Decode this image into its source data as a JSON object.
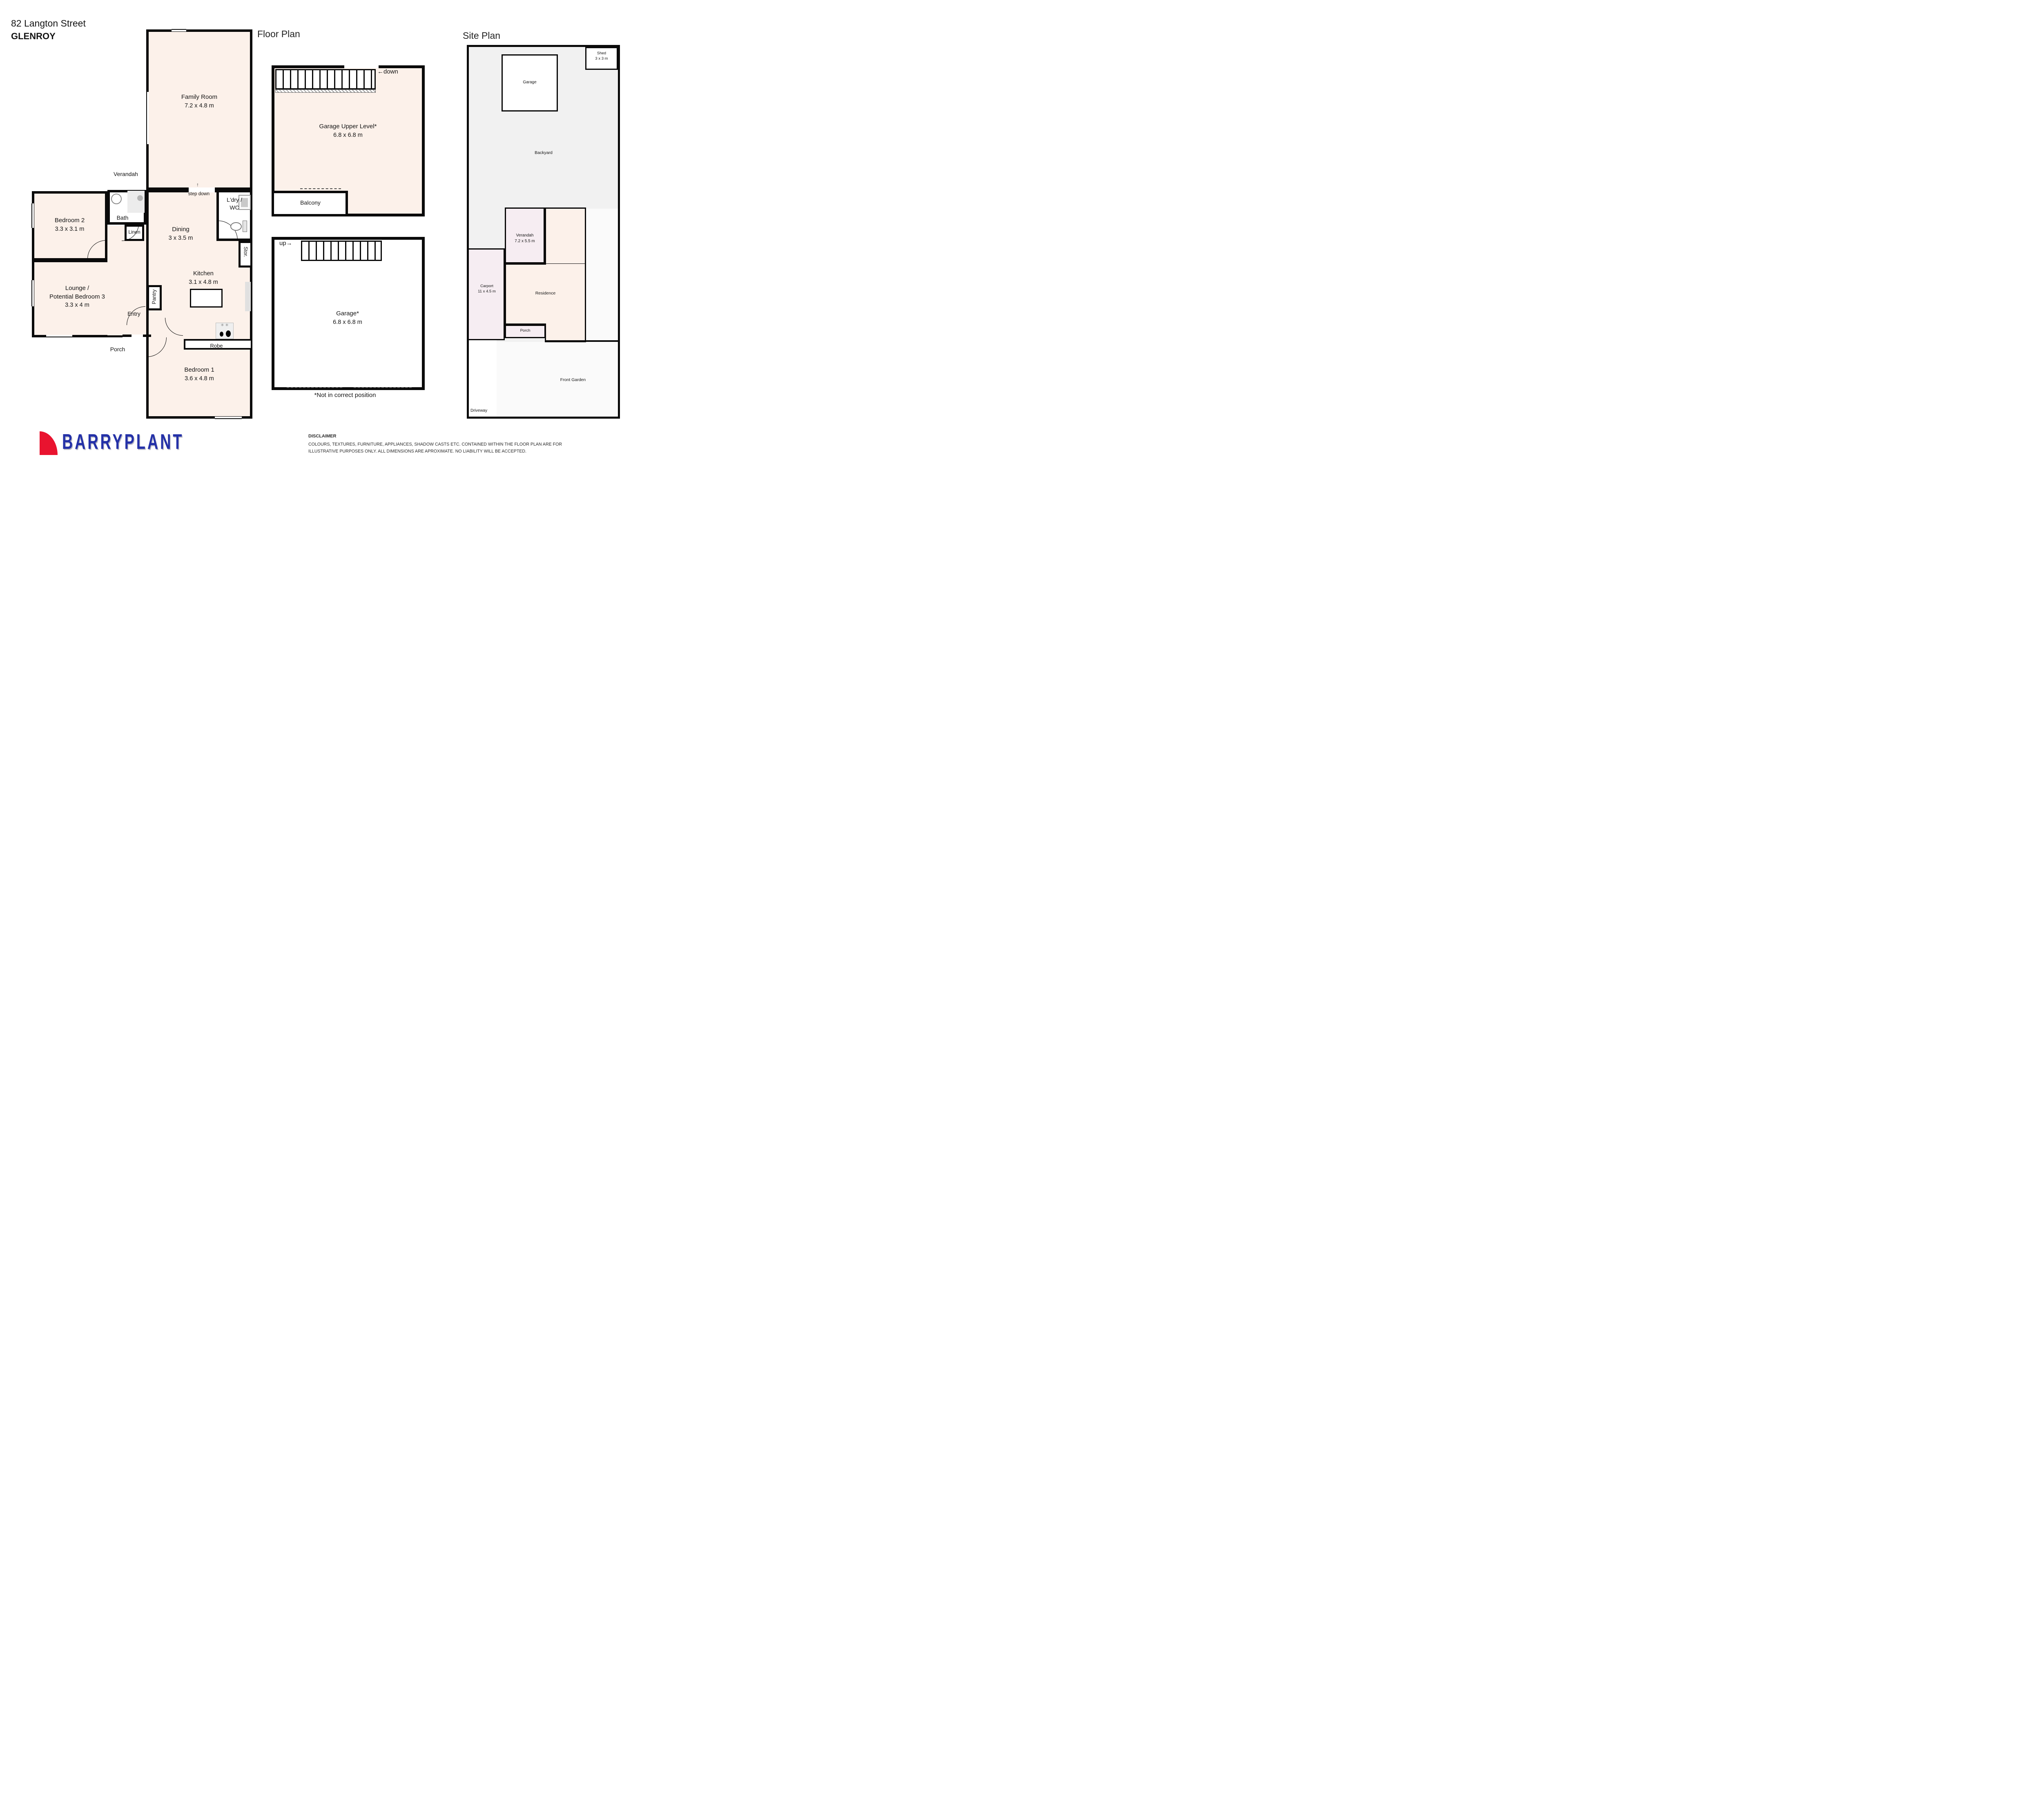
{
  "header": {
    "address_line1": "82 Langton Street",
    "address_line2": "GLENROY",
    "floor_plan_title": "Floor Plan",
    "site_plan_title": "Site Plan"
  },
  "floor_plan": {
    "rooms": {
      "family_room": {
        "name": "Family Room",
        "dims": "7.2 x 4.8 m"
      },
      "bedroom_2": {
        "name": "Bedroom 2",
        "dims": "3.3 x 3.1 m"
      },
      "bath": {
        "name": "Bath"
      },
      "linen": {
        "name": "Linen"
      },
      "dining": {
        "name": "Dining",
        "dims": "3 x 3.5 m"
      },
      "laundry_wc": {
        "line1": "L'dry /",
        "line2": "WC"
      },
      "storage": {
        "name": "Stor."
      },
      "kitchen": {
        "name": "Kitchen",
        "dims": "3.1 x 4.8 m"
      },
      "pantry": {
        "name": "Pantry"
      },
      "lounge": {
        "line1": "Lounge /",
        "line2": "Potential Bedroom 3",
        "dims": "3.3 x 4 m"
      },
      "entry": {
        "name": "Entry"
      },
      "robe": {
        "name": "Robe"
      },
      "bedroom_1": {
        "name": "Bedroom 1",
        "dims": "3.6 x 4.8 m"
      },
      "garage_upper": {
        "name": "Garage Upper Level*",
        "dims": "6.8 x 6.8 m"
      },
      "balcony": {
        "name": "Balcony"
      },
      "garage": {
        "name": "Garage*",
        "dims": "6.8 x 6.8 m"
      }
    },
    "labels": {
      "verandah": "Verandah",
      "porch": "Porch",
      "step_down": "step down",
      "step_arrow": "↑",
      "stairs_down": "←down",
      "stairs_up": "up→",
      "position_note": "*Not in correct position"
    }
  },
  "site_plan": {
    "areas": {
      "shed": {
        "name": "Shed",
        "dims": "3 x 3 m"
      },
      "garage": {
        "name": "Garage"
      },
      "backyard": {
        "name": "Backyard"
      },
      "verandah": {
        "name": "Verandah",
        "dims": "7.2 x 5.5 m"
      },
      "carport": {
        "name": "Carport",
        "dims": "11 x 4.5 m"
      },
      "residence": {
        "name": "Residence"
      },
      "porch": {
        "name": "Porch"
      },
      "front_garden": {
        "name": "Front Garden"
      },
      "driveway": {
        "name": "Driveway"
      }
    }
  },
  "footer": {
    "brand": "BARRYPLANT",
    "disclaimer_title": "DISCLAIMER",
    "disclaimer_body": "COLOURS, TEXTURES, FURNITURE, APPLIANCES, SHADOW CASTS ETC. CONTAINED WITHIN THE FLOOR PLAN ARE FOR ILLUSTRATIVE PURPOSES ONLY. ALL DIMENSIONS ARE APROXIMATE. NO LIABILITY WILL BE ACCEPTED."
  },
  "colors": {
    "room_fill": "#fcf1ea",
    "site_base": "#f1f1f1",
    "site_pink": "#f6edf2",
    "wall": "#0a0a0a",
    "brand_blue": "#2431a8",
    "brand_red": "#e9132f"
  }
}
